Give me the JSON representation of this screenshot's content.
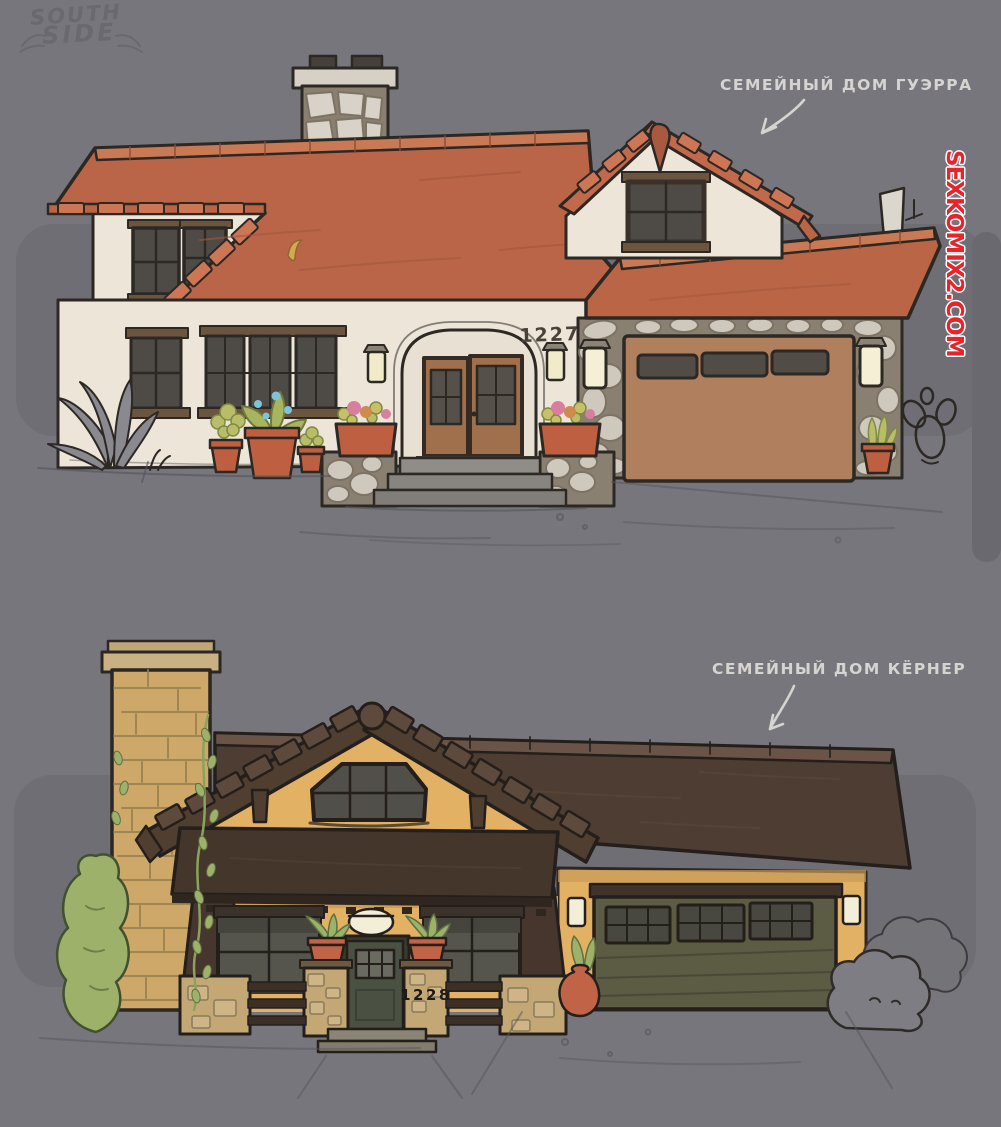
{
  "scene": {
    "background_color": "#77767c",
    "panel_color": "#6f6e74",
    "caption_color": "#d6d4d0"
  },
  "logo": {
    "line1": "SOUTH",
    "line2": "SIDE"
  },
  "watermark": {
    "text": "SEXKOMIX2.COM",
    "color": "#e7242c"
  },
  "houses": [
    {
      "id": "guerra-house",
      "label": "СЕМЕЙНЫЙ ДОМ ГУЭРРА",
      "house_number": "1227",
      "palette": {
        "roof": "#ba6547",
        "ridge": "#c97a55",
        "wall": "#ece5d8",
        "stone": "#ccc5ba",
        "garage_door": "#b07f5d",
        "front_door": "#a06f4b",
        "window": "#4e4a45",
        "trim": "#6b553f",
        "planter": "#bf5f41",
        "lantern_glow": "#f2ebc9"
      }
    },
    {
      "id": "kerner-house",
      "label": "СЕМЕЙНЫЙ ДОМ КЁРНЕР",
      "house_number": "1228",
      "palette": {
        "roof": "#4e3d33",
        "fascia": "#6a5447",
        "wall": "#e2b164",
        "chimney_brick": "#cda869",
        "stone": "#c3a876",
        "garage_door": "#5c5b44",
        "front_door": "#4a5142",
        "window": "#55554e",
        "plant": "#9db16a",
        "pot": "#c06346"
      }
    }
  ]
}
